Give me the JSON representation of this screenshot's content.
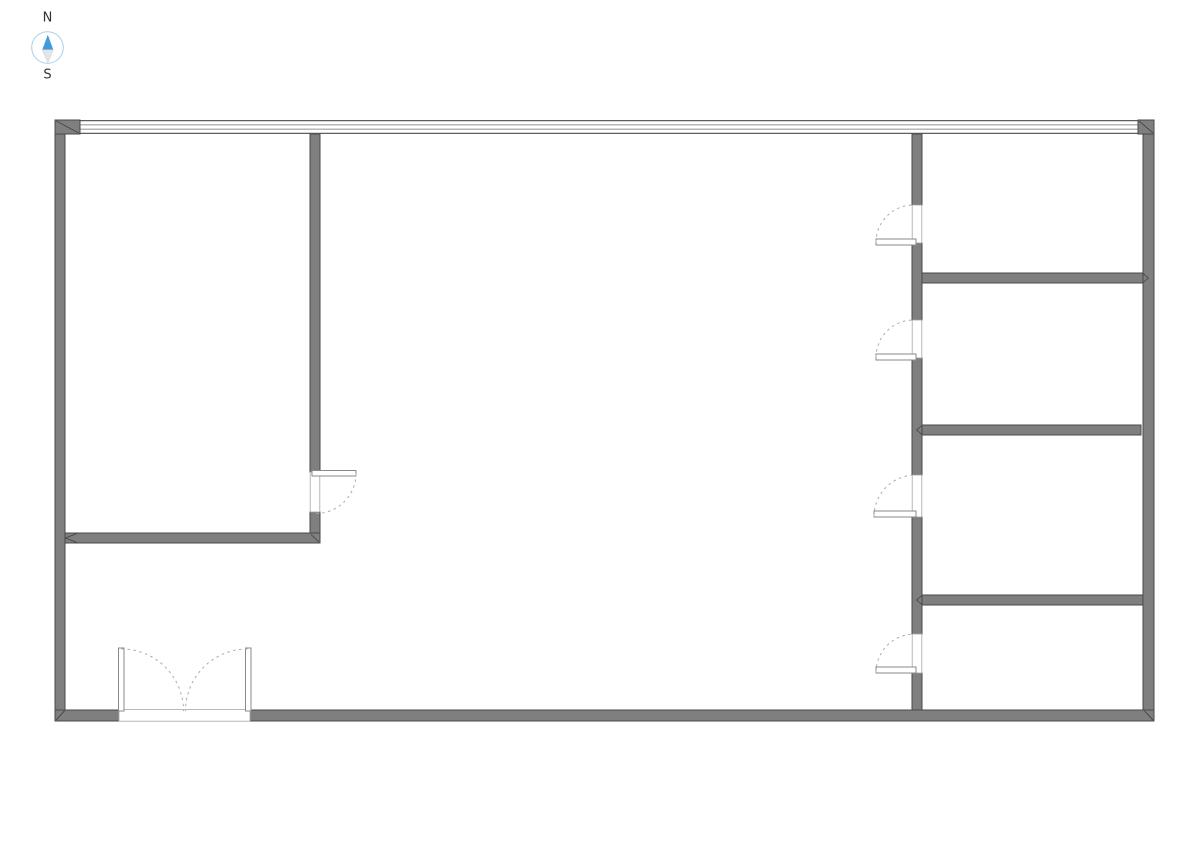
{
  "title": "Floor plan drawing with north arrow",
  "compass": {
    "north_label": "N",
    "south_label": "S",
    "needle_icon": "compass-needle-icon"
  },
  "colors": {
    "wall_fill": "#7f7f7f",
    "wall_stroke": "#4a4a4a",
    "window_line": "#5f5f5f",
    "door_swing": "#ababab",
    "compass_north_blue": "#3f9ade",
    "compass_south_gray": "#e2e6e9",
    "compass_ring_blue": "#a9cfec",
    "label_text": "#2e3338",
    "background": "#ffffff"
  },
  "drawing": {
    "canvas": {
      "width": 1191,
      "height": 842,
      "background": "#ffffff"
    },
    "styles": {
      "window-line-outer": {
        "fill": "none",
        "stroke": "#5f5f5f",
        "stroke-width": 1.2
      },
      "window-line-inner": {
        "fill": "none",
        "stroke": "#6e6e6e",
        "stroke-width": 0.8
      },
      "wall": {
        "fill": "#7f7f7f",
        "stroke": "#4a4a4a",
        "stroke-width": 1
      },
      "miter": {
        "fill": "none",
        "stroke": "#3f3f3f",
        "stroke-width": 0.8
      },
      "opening": {
        "fill": "#ffffff",
        "stroke": "#a6a6a6",
        "stroke-width": 0.8
      },
      "leaf": {
        "fill": "#ffffff",
        "stroke": "#8a8a8a",
        "stroke-width": 1
      },
      "arc": {
        "fill": "none",
        "stroke": "#ababab",
        "stroke-width": 1,
        "stroke-dasharray": "2.5 3.5"
      },
      "compass-ring": {
        "fill": "#ffffff",
        "stroke": "#a9cfec",
        "stroke-width": 1
      },
      "compass-north": {
        "fill": "#3f9ade",
        "stroke": "none"
      },
      "compass-south": {
        "fill": "#e2e6e9",
        "stroke": "#c9ced2",
        "stroke-width": 0.5
      },
      "compass-label": {
        "fill": "#2e3338",
        "stroke": "none",
        "font-size": 13
      }
    },
    "elements": [
      {
        "type": "line",
        "name": "window-wall-line-outer-top",
        "style": "window-line-outer",
        "x1": 80,
        "y1": 120.6,
        "x2": 1138,
        "y2": 120.6
      },
      {
        "type": "line",
        "name": "window-wall-line-inner-1",
        "style": "window-line-inner",
        "x1": 80,
        "y1": 124.9,
        "x2": 1138,
        "y2": 124.9
      },
      {
        "type": "line",
        "name": "window-wall-line-inner-2",
        "style": "window-line-inner",
        "x1": 80,
        "y1": 129.1,
        "x2": 1138,
        "y2": 129.1
      },
      {
        "type": "line",
        "name": "window-wall-line-outer-bottom",
        "style": "window-line-outer",
        "x1": 80,
        "y1": 133.4,
        "x2": 1138,
        "y2": 133.4
      },
      {
        "type": "rect",
        "name": "corner-block-top-left",
        "style": "wall",
        "x": 55,
        "y": 120,
        "width": 25,
        "height": 14
      },
      {
        "type": "rect",
        "name": "corner-block-top-right",
        "style": "wall",
        "x": 1138,
        "y": 120,
        "width": 16,
        "height": 14
      },
      {
        "type": "rect",
        "name": "wall-exterior-left",
        "style": "wall",
        "x": 55,
        "y": 134,
        "width": 10,
        "height": 576
      },
      {
        "type": "rect",
        "name": "wall-exterior-right",
        "style": "wall",
        "x": 1143,
        "y": 134,
        "width": 11,
        "height": 576
      },
      {
        "type": "rect",
        "name": "wall-exterior-bottom",
        "style": "wall",
        "x": 55,
        "y": 710,
        "width": 1099,
        "height": 11
      },
      {
        "type": "rect",
        "name": "wall-left-room-vertical",
        "style": "wall",
        "x": 310,
        "y": 134,
        "width": 10,
        "height": 338
      },
      {
        "type": "rect",
        "name": "wall-left-room-stub",
        "style": "wall",
        "x": 310,
        "y": 512,
        "width": 10,
        "height": 22
      },
      {
        "type": "rect",
        "name": "wall-left-room-horizontal",
        "style": "wall",
        "x": 65,
        "y": 533,
        "width": 255,
        "height": 10
      },
      {
        "type": "rect",
        "name": "wall-corridor-segment-1",
        "style": "wall",
        "x": 912,
        "y": 134,
        "width": 10,
        "height": 71
      },
      {
        "type": "rect",
        "name": "wall-corridor-segment-2",
        "style": "wall",
        "x": 912,
        "y": 243,
        "width": 10,
        "height": 77
      },
      {
        "type": "rect",
        "name": "wall-corridor-segment-3",
        "style": "wall",
        "x": 912,
        "y": 358,
        "width": 10,
        "height": 117
      },
      {
        "type": "rect",
        "name": "wall-corridor-segment-4",
        "style": "wall",
        "x": 912,
        "y": 517,
        "width": 10,
        "height": 117
      },
      {
        "type": "rect",
        "name": "wall-corridor-segment-5",
        "style": "wall",
        "x": 912,
        "y": 673,
        "width": 10,
        "height": 37
      },
      {
        "type": "rect",
        "name": "wall-right-room-divider-1",
        "style": "wall",
        "x": 922,
        "y": 273,
        "width": 221,
        "height": 10
      },
      {
        "type": "rect",
        "name": "wall-right-room-divider-2",
        "style": "wall",
        "x": 922,
        "y": 425,
        "width": 219,
        "height": 10
      },
      {
        "type": "rect",
        "name": "wall-right-room-divider-3",
        "style": "wall",
        "x": 922,
        "y": 595,
        "width": 221,
        "height": 10
      },
      {
        "type": "line",
        "name": "miter-top-left",
        "style": "miter",
        "x1": 56,
        "y1": 120.8,
        "x2": 79,
        "y2": 133.2
      },
      {
        "type": "line",
        "name": "miter-top-right",
        "style": "miter",
        "x1": 1139,
        "y1": 121,
        "x2": 1153,
        "y2": 133
      },
      {
        "type": "line",
        "name": "miter-bottom-left",
        "style": "miter",
        "x1": 56,
        "y1": 720.2,
        "x2": 64.5,
        "y2": 710.8
      },
      {
        "type": "line",
        "name": "miter-bottom-right",
        "style": "miter",
        "x1": 1144.5,
        "y1": 710.8,
        "x2": 1153,
        "y2": 720.2
      },
      {
        "type": "line",
        "name": "miter-left-room-a",
        "style": "miter",
        "x1": 65.5,
        "y1": 538,
        "x2": 77,
        "y2": 533.5
      },
      {
        "type": "line",
        "name": "miter-left-room-b",
        "style": "miter",
        "x1": 65.5,
        "y1": 538,
        "x2": 77,
        "y2": 542.5
      },
      {
        "type": "line",
        "name": "miter-stub-corner",
        "style": "miter",
        "x1": 311,
        "y1": 534.5,
        "x2": 319,
        "y2": 542
      },
      {
        "type": "line",
        "name": "miter-divider1-right-a",
        "style": "miter",
        "x1": 1143,
        "y1": 273.5,
        "x2": 1148.5,
        "y2": 278
      },
      {
        "type": "line",
        "name": "miter-divider1-right-b",
        "style": "miter",
        "x1": 1143,
        "y1": 282.5,
        "x2": 1148.5,
        "y2": 278
      },
      {
        "type": "line",
        "name": "miter-divider2-left-a",
        "style": "miter",
        "x1": 922,
        "y1": 425.5,
        "x2": 916.5,
        "y2": 430
      },
      {
        "type": "line",
        "name": "miter-divider2-left-b",
        "style": "miter",
        "x1": 922,
        "y1": 434.5,
        "x2": 916.5,
        "y2": 430
      },
      {
        "type": "line",
        "name": "miter-divider3-left-a",
        "style": "miter",
        "x1": 922,
        "y1": 595.5,
        "x2": 916.5,
        "y2": 600
      },
      {
        "type": "line",
        "name": "miter-divider3-left-b",
        "style": "miter",
        "x1": 922,
        "y1": 604.5,
        "x2": 916.5,
        "y2": 600
      },
      {
        "type": "rect",
        "name": "door-opening-left-room",
        "style": "opening",
        "x": 310.2,
        "y": 472,
        "width": 9.6,
        "height": 40
      },
      {
        "type": "rect",
        "name": "door-opening-room-1",
        "style": "opening",
        "x": 912.2,
        "y": 205,
        "width": 9.6,
        "height": 38
      },
      {
        "type": "rect",
        "name": "door-opening-room-2",
        "style": "opening",
        "x": 912.2,
        "y": 320,
        "width": 9.6,
        "height": 38
      },
      {
        "type": "rect",
        "name": "door-opening-room-3",
        "style": "opening",
        "x": 912.2,
        "y": 475,
        "width": 9.6,
        "height": 42
      },
      {
        "type": "rect",
        "name": "door-opening-room-4",
        "style": "opening",
        "x": 912.2,
        "y": 634,
        "width": 9.6,
        "height": 39
      },
      {
        "type": "rect",
        "name": "entrance-door-opening",
        "style": "opening",
        "x": 119,
        "y": 709.6,
        "width": 131,
        "height": 11.6
      },
      {
        "type": "rect",
        "name": "door-leaf-left-room",
        "style": "leaf",
        "x": 312,
        "y": 470.5,
        "width": 44,
        "height": 5.5
      },
      {
        "type": "rect",
        "name": "door-leaf-room-1",
        "style": "leaf",
        "x": 876,
        "y": 239,
        "width": 40,
        "height": 6
      },
      {
        "type": "rect",
        "name": "door-leaf-room-2",
        "style": "leaf",
        "x": 876,
        "y": 354,
        "width": 40,
        "height": 6
      },
      {
        "type": "rect",
        "name": "door-leaf-room-3",
        "style": "leaf",
        "x": 874,
        "y": 511,
        "width": 42,
        "height": 6
      },
      {
        "type": "rect",
        "name": "door-leaf-room-4",
        "style": "leaf",
        "x": 876,
        "y": 667,
        "width": 40,
        "height": 6
      },
      {
        "type": "rect",
        "name": "entrance-door-leaf-left",
        "style": "leaf",
        "x": 118.5,
        "y": 648,
        "width": 5.5,
        "height": 63
      },
      {
        "type": "rect",
        "name": "entrance-door-leaf-right",
        "style": "leaf",
        "x": 245.5,
        "y": 648,
        "width": 5.5,
        "height": 63
      },
      {
        "type": "path",
        "name": "door-swing-left-room",
        "style": "arc",
        "d": "M 356 473.5 A 40 40 0 0 1 316 513.5"
      },
      {
        "type": "path",
        "name": "door-swing-room-1",
        "style": "arc",
        "d": "M 876 242.5 A 37.5 37.5 0 0 1 913.5 205"
      },
      {
        "type": "path",
        "name": "door-swing-room-2",
        "style": "arc",
        "d": "M 876 357.5 A 37.5 37.5 0 0 1 913.5 320"
      },
      {
        "type": "path",
        "name": "door-swing-room-3",
        "style": "arc",
        "d": "M 874 516.5 A 41.5 41.5 0 0 1 915.5 475"
      },
      {
        "type": "path",
        "name": "door-swing-room-4",
        "style": "arc",
        "d": "M 876 672.5 A 38.5 38.5 0 0 1 914.5 634"
      },
      {
        "type": "path",
        "name": "entrance-swing-left",
        "style": "arc",
        "d": "M 121.5 649 A 62 62 0 0 1 183.5 711"
      },
      {
        "type": "path",
        "name": "entrance-swing-right",
        "style": "arc",
        "d": "M 247.5 649 A 62 62 0 0 0 185.5 711"
      },
      {
        "type": "circle",
        "name": "compass-ring",
        "style": "compass-ring",
        "cx": 47.5,
        "cy": 47.5,
        "r": 15.8
      },
      {
        "type": "polygon",
        "name": "compass-needle-north-icon",
        "style": "compass-north",
        "points": "47.8,34.8 42.3,49.8 53.3,49.8"
      },
      {
        "type": "polygon",
        "name": "compass-needle-south-icon",
        "style": "compass-south",
        "points": "47.8,62.8 42.3,49.8 53.3,49.8"
      },
      {
        "type": "text",
        "name": "compass-label-north",
        "style": "compass-label",
        "x": 47.5,
        "y": 21.5,
        "bind": "compass.north_label"
      },
      {
        "type": "text",
        "name": "compass-label-south",
        "style": "compass-label",
        "x": 47.5,
        "y": 78.5,
        "bind": "compass.south_label"
      }
    ]
  }
}
